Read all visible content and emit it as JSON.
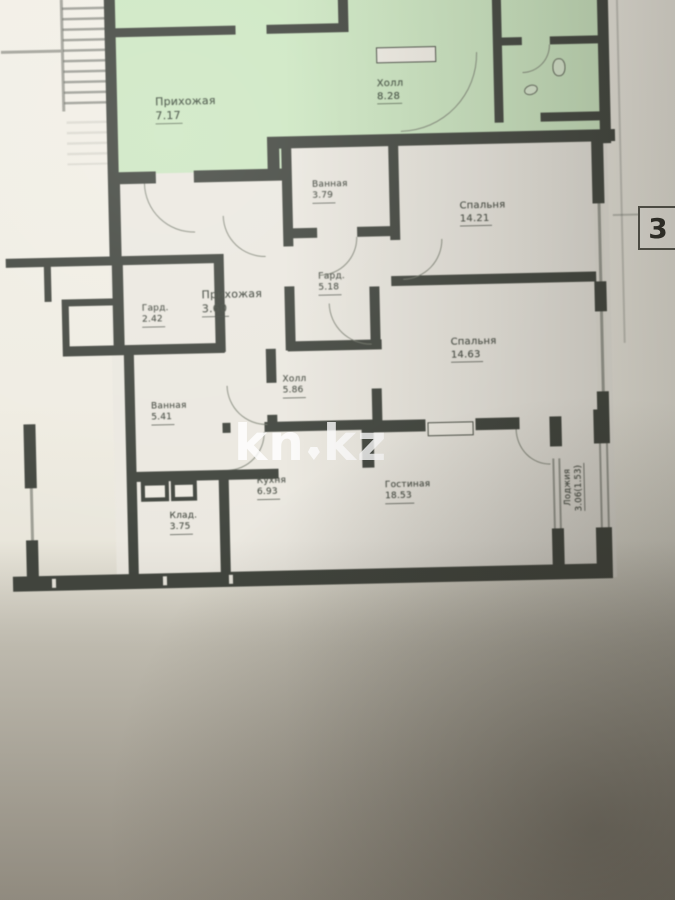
{
  "watermark": {
    "prefix": "kn",
    "suffix": "kz"
  },
  "plan_number_label": "3",
  "rooms": [
    {
      "name": "Прихожая",
      "area": "7.17"
    },
    {
      "name": "Холл",
      "area": "8.28"
    },
    {
      "name": "Ванная",
      "area": "3.79"
    },
    {
      "name": "Спальня",
      "area": "14.21"
    },
    {
      "name": "Гард.",
      "area": "5.18"
    },
    {
      "name": "Прихожая",
      "area": "3.60"
    },
    {
      "name": "Гард.",
      "area": "2.42"
    },
    {
      "name": "Спальня",
      "area": "14.63"
    },
    {
      "name": "Холл",
      "area": "5.86"
    },
    {
      "name": "Ванная",
      "area": "5.41"
    },
    {
      "name": "Кухня",
      "area": "6.93"
    },
    {
      "name": "Гостиная",
      "area": "18.53"
    },
    {
      "name": "Клад.",
      "area": "3.75"
    },
    {
      "name": "Лоджия",
      "area": "3.06(1.53)"
    }
  ],
  "colors": {
    "highlight_green": "#cde7c2",
    "wall": "#41453e",
    "paper": "#efece2",
    "watermark": "#ffffff"
  }
}
